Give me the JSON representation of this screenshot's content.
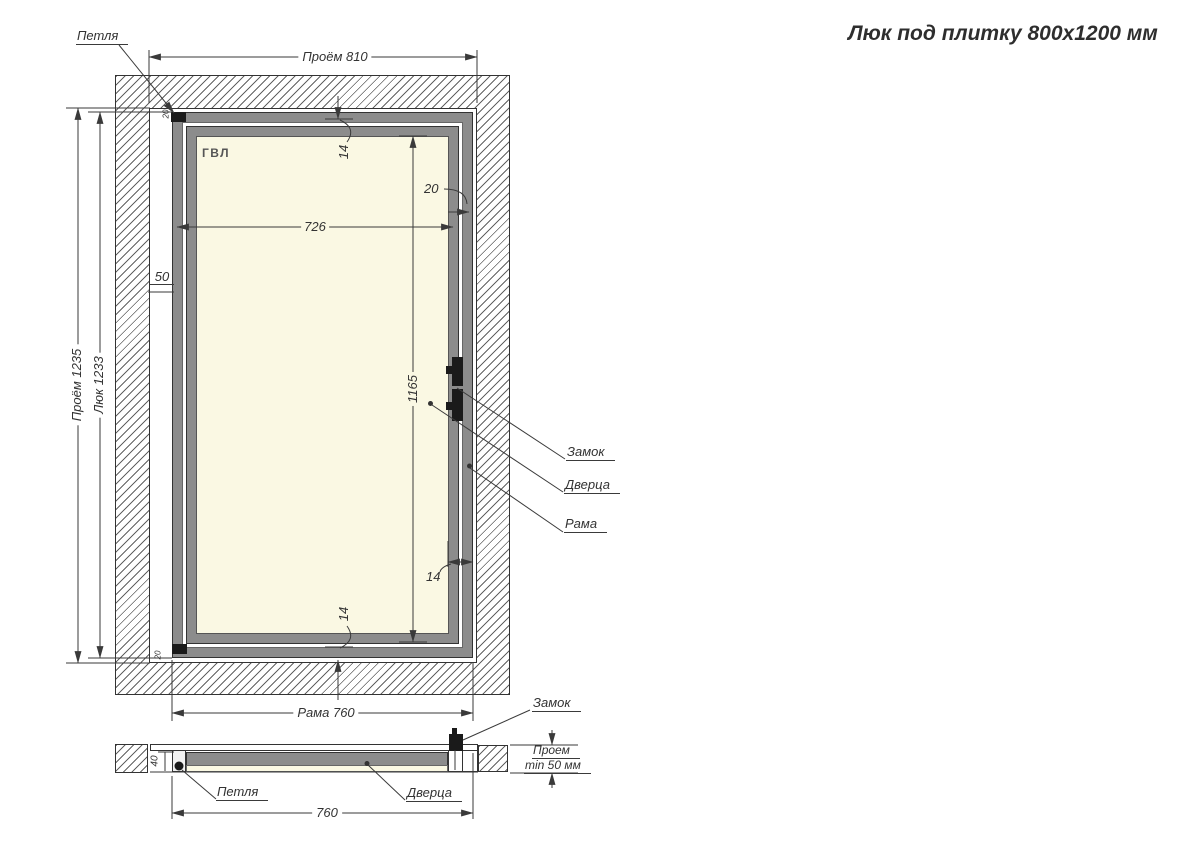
{
  "title": "Люк под плитку 800х1200 мм",
  "front_view": {
    "material": "ГВЛ",
    "hinge": "Петля",
    "lock": "Замок",
    "door": "Дверца",
    "frame": "Рама",
    "dim_opening_width": "Проём 810",
    "dim_opening_height": "Проём 1235",
    "dim_hatch": "Люк 1233",
    "dim_inner_width": "726",
    "dim_side_gap": "50",
    "dim_overlap_top": "14",
    "dim_lock_gap": "20",
    "dim_door_height": "1165",
    "dim_overlap_right": "14",
    "dim_overlap_bottom": "14",
    "dim_frame_width": "Рама 760",
    "dim_hinge_offset_top": "20",
    "dim_hinge_offset_bottom": "20"
  },
  "section_view": {
    "lock": "Замок",
    "hinge": "Петля",
    "door": "Дверца",
    "dim_width": "760",
    "dim_depth": "40",
    "dim_opening_depth_line1": "Проем",
    "dim_opening_depth_line2": "min 50 мм"
  },
  "colors": {
    "line": "#3a3a3a",
    "frame_gray": "#8c8c8c",
    "panel_yellow": "#faf8e3",
    "lock_black": "#1a1a1a"
  }
}
